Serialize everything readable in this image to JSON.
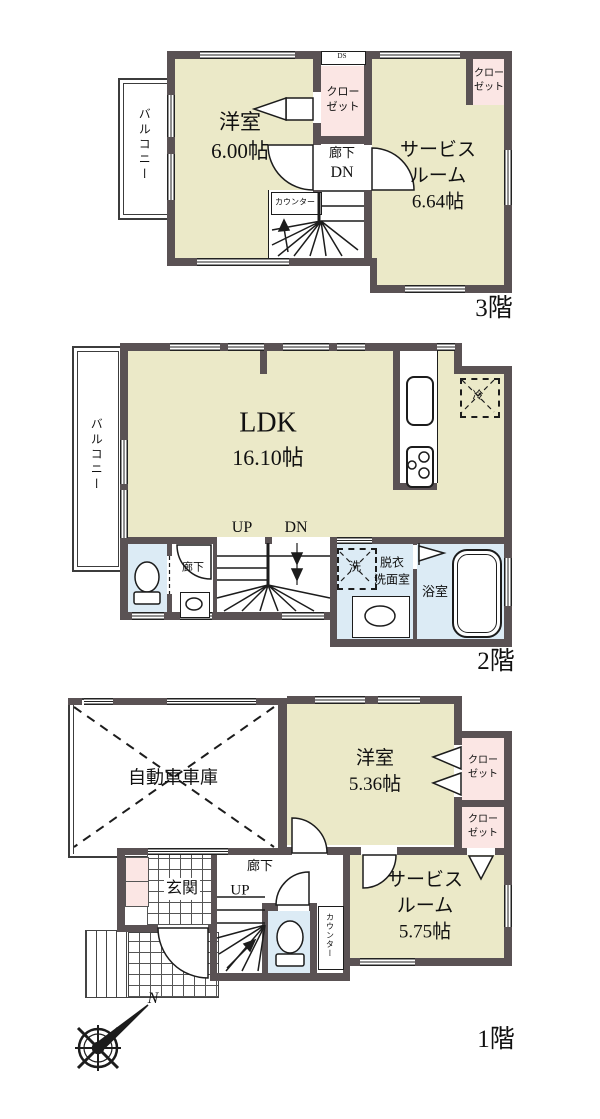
{
  "colors": {
    "wall": "#5a5254",
    "room_beige": "#ebe9c8",
    "closet_pink": "#fbe6e4",
    "wet_blue": "#dcebf5",
    "line": "#1c1c1c"
  },
  "f3": {
    "floor_label": "3階",
    "balcony": "バルコニー",
    "yoshitsu": {
      "name": "洋室",
      "size": "6.00帖"
    },
    "closet_mid": {
      "line1": "クロー",
      "line2": "ゼット"
    },
    "closet_tr": {
      "line1": "クロー",
      "line2": "ゼット"
    },
    "hall": {
      "name": "廊下",
      "dir": "DN"
    },
    "service": {
      "name1": "サービス",
      "name2": "ルーム",
      "size": "6.64帖"
    },
    "counter": "カウンター",
    "ds": "DS"
  },
  "f2": {
    "floor_label": "2階",
    "balcony": "バルコニー",
    "ldk": {
      "name": "LDK",
      "size": "16.10帖"
    },
    "up": "UP",
    "dn": "DN",
    "hall": "廊下",
    "washer": "洗",
    "datsui": {
      "line1": "脱衣",
      "line2": "洗面室"
    },
    "bath": "浴室",
    "fridge": "冷"
  },
  "f1": {
    "floor_label": "1階",
    "garage": "自動車車庫",
    "yoshitsu": {
      "name": "洋室",
      "size": "5.36帖"
    },
    "closet1": {
      "line1": "クロー",
      "line2": "ゼット"
    },
    "closet2": {
      "line1": "クロー",
      "line2": "ゼット"
    },
    "hall": "廊下",
    "up": "UP",
    "genkan": "玄関",
    "counter": "カウンター",
    "service": {
      "name1": "サービス",
      "name2": "ルーム",
      "size": "5.75帖"
    },
    "compass_n": "N"
  }
}
